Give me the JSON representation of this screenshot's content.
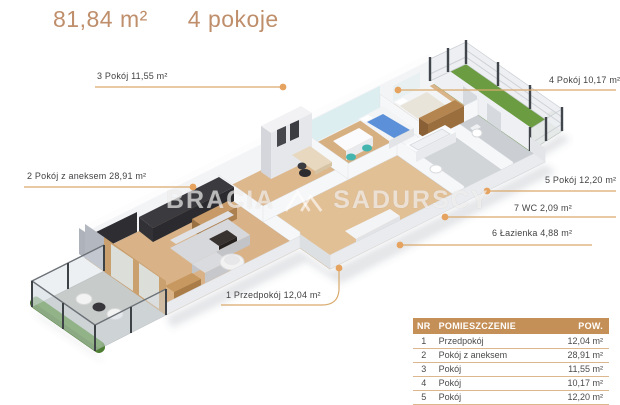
{
  "header": {
    "area": "81,84 m²",
    "rooms": "4 pokoje"
  },
  "watermark": {
    "brand_left": "BRACIA",
    "brand_right": "SADURSCY",
    "logo": "twin-peaks-mark"
  },
  "labels": {
    "hallway": "1 Przedpokój 12,04 m²",
    "living": "2 Pokój z aneksem 28,91 m²",
    "room3": "3 Pokój 11,55 m²",
    "room4": "4 Pokój 10,17 m²",
    "room5": "5 Pokój 12,20 m²",
    "bathroom": "6 Łazienka 4,88 m²",
    "wc": "7 WC 2,09 m²"
  },
  "table": {
    "headers": {
      "nr": "NR",
      "name": "POMIESZCZENIE",
      "area": "POW."
    },
    "rows": [
      {
        "nr": "1",
        "name": "Przedpokój",
        "area": "12,04 m²"
      },
      {
        "nr": "2",
        "name": "Pokój z aneksem",
        "area": "28,91 m²"
      },
      {
        "nr": "3",
        "name": "Pokój",
        "area": "11,55 m²"
      },
      {
        "nr": "4",
        "name": "Pokój",
        "area": "10,17 m²"
      },
      {
        "nr": "5",
        "name": "Pokój",
        "area": "12,20 m²"
      }
    ]
  },
  "colors": {
    "accent_title": "#bf8e6b",
    "leader_line": "#d9a96c",
    "leader_dot": "#e5a35f",
    "table_header_bg": "#c59058",
    "wood_floor": "#d9b287",
    "tile_floor": "#d2d5d8",
    "lawn_green": "#6b9c42",
    "hedge_green": "#4e7e33",
    "watermark_white": "#ffffff"
  }
}
